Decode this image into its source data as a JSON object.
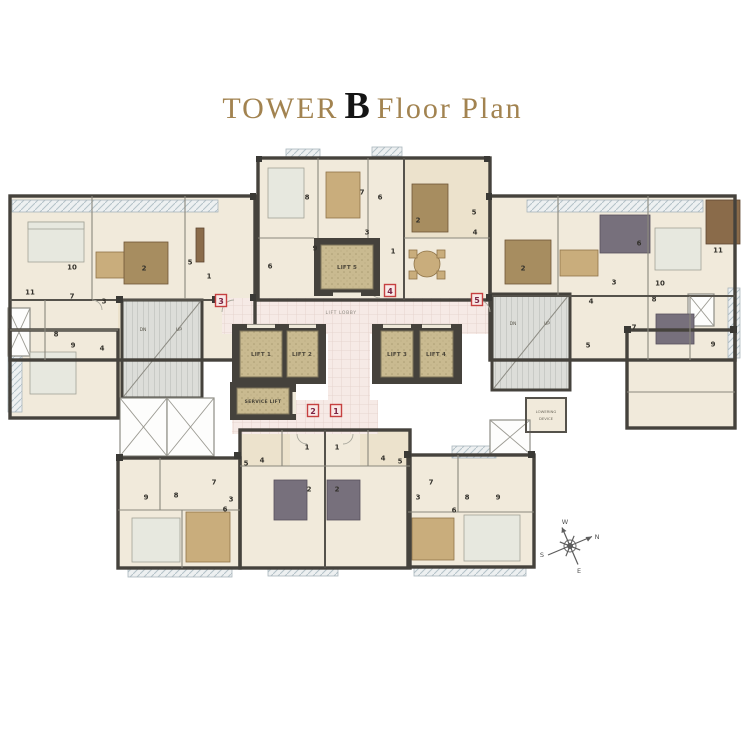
{
  "title": {
    "prefix": "TOWER",
    "emphasis": "B",
    "suffix": "Floor Plan"
  },
  "colors": {
    "title_gold": "#a28350",
    "title_black": "#141414",
    "wall": "#45423c",
    "floor_cream": "#f1eadb",
    "lift_tan": "#c9ba90",
    "lobby_pink": "#f6eae6",
    "marker_red": "#c64040",
    "marker_number": "#7c2342"
  },
  "plan": {
    "lobby_label": "LIFT LOBBY",
    "lifts": {
      "lift1": "LIFT 1",
      "lift2": "LIFT 2",
      "lift3": "LIFT 3",
      "lift4": "LIFT 4",
      "lift5": "LIFT 5",
      "service": "SERVICE LIFT"
    },
    "stairs": {
      "down": "DN",
      "up": "UP"
    },
    "lowering_device": {
      "line1": "LOWERING",
      "line2": "DEVICE"
    },
    "markers": [
      {
        "n": "1",
        "x": 336,
        "y": 411
      },
      {
        "n": "2",
        "x": 313,
        "y": 411
      },
      {
        "n": "3",
        "x": 221,
        "y": 301
      },
      {
        "n": "4",
        "x": 390,
        "y": 291
      },
      {
        "n": "5",
        "x": 477,
        "y": 300
      }
    ],
    "room_numbers": [
      {
        "unit": "west-wing",
        "n": "1",
        "x": 209,
        "y": 276
      },
      {
        "unit": "west-wing",
        "n": "2",
        "x": 144,
        "y": 268
      },
      {
        "unit": "west-wing",
        "n": "3",
        "x": 104,
        "y": 301
      },
      {
        "unit": "west-wing",
        "n": "4",
        "x": 102,
        "y": 348
      },
      {
        "unit": "west-wing",
        "n": "5",
        "x": 190,
        "y": 262
      },
      {
        "unit": "west-wing",
        "n": "6",
        "x": 270,
        "y": 266
      },
      {
        "unit": "west-wing",
        "n": "7",
        "x": 72,
        "y": 296
      },
      {
        "unit": "west-wing",
        "n": "8",
        "x": 56,
        "y": 334
      },
      {
        "unit": "west-wing",
        "n": "9",
        "x": 73,
        "y": 345
      },
      {
        "unit": "west-wing",
        "n": "10",
        "x": 72,
        "y": 267
      },
      {
        "unit": "west-wing",
        "n": "11",
        "x": 30,
        "y": 292
      },
      {
        "unit": "east-wing",
        "n": "2",
        "x": 523,
        "y": 268
      },
      {
        "unit": "east-wing",
        "n": "3",
        "x": 614,
        "y": 282
      },
      {
        "unit": "east-wing",
        "n": "4",
        "x": 591,
        "y": 301
      },
      {
        "unit": "east-wing",
        "n": "5",
        "x": 588,
        "y": 345
      },
      {
        "unit": "east-wing",
        "n": "6",
        "x": 639,
        "y": 243
      },
      {
        "unit": "east-wing",
        "n": "7",
        "x": 634,
        "y": 327
      },
      {
        "unit": "east-wing",
        "n": "8",
        "x": 654,
        "y": 299
      },
      {
        "unit": "east-wing",
        "n": "9",
        "x": 713,
        "y": 344
      },
      {
        "unit": "east-wing",
        "n": "10",
        "x": 660,
        "y": 283
      },
      {
        "unit": "east-wing",
        "n": "11",
        "x": 718,
        "y": 250
      },
      {
        "unit": "north-center",
        "n": "1",
        "x": 393,
        "y": 251
      },
      {
        "unit": "north-center",
        "n": "2",
        "x": 418,
        "y": 220
      },
      {
        "unit": "north-center",
        "n": "3",
        "x": 367,
        "y": 232
      },
      {
        "unit": "north-center",
        "n": "4",
        "x": 475,
        "y": 232
      },
      {
        "unit": "north-center",
        "n": "5",
        "x": 474,
        "y": 212
      },
      {
        "unit": "north-center",
        "n": "6",
        "x": 380,
        "y": 197
      },
      {
        "unit": "north-center",
        "n": "7",
        "x": 362,
        "y": 192
      },
      {
        "unit": "north-center",
        "n": "8",
        "x": 307,
        "y": 197
      },
      {
        "unit": "north-center",
        "n": "9",
        "x": 315,
        "y": 248
      },
      {
        "unit": "south-west",
        "n": "3",
        "x": 231,
        "y": 499
      },
      {
        "unit": "south-west",
        "n": "4",
        "x": 262,
        "y": 460
      },
      {
        "unit": "south-west",
        "n": "5",
        "x": 246,
        "y": 463
      },
      {
        "unit": "south-west",
        "n": "6",
        "x": 225,
        "y": 509
      },
      {
        "unit": "south-west",
        "n": "7",
        "x": 214,
        "y": 482
      },
      {
        "unit": "south-west",
        "n": "8",
        "x": 176,
        "y": 495
      },
      {
        "unit": "south-west",
        "n": "9",
        "x": 146,
        "y": 497
      },
      {
        "unit": "south-center-west",
        "n": "1",
        "x": 307,
        "y": 447
      },
      {
        "unit": "south-center-west",
        "n": "2",
        "x": 309,
        "y": 489
      },
      {
        "unit": "south-center-east",
        "n": "1",
        "x": 337,
        "y": 447
      },
      {
        "unit": "south-center-east",
        "n": "2",
        "x": 337,
        "y": 489
      },
      {
        "unit": "south-east",
        "n": "3",
        "x": 418,
        "y": 497
      },
      {
        "unit": "south-east",
        "n": "4",
        "x": 383,
        "y": 458
      },
      {
        "unit": "south-east",
        "n": "5",
        "x": 400,
        "y": 461
      },
      {
        "unit": "south-east",
        "n": "6",
        "x": 454,
        "y": 510
      },
      {
        "unit": "south-east",
        "n": "7",
        "x": 431,
        "y": 482
      },
      {
        "unit": "south-east",
        "n": "8",
        "x": 467,
        "y": 497
      },
      {
        "unit": "south-east",
        "n": "9",
        "x": 498,
        "y": 497
      }
    ],
    "compass": {
      "w": "W",
      "n": "N",
      "s": "S",
      "e": "E"
    }
  }
}
